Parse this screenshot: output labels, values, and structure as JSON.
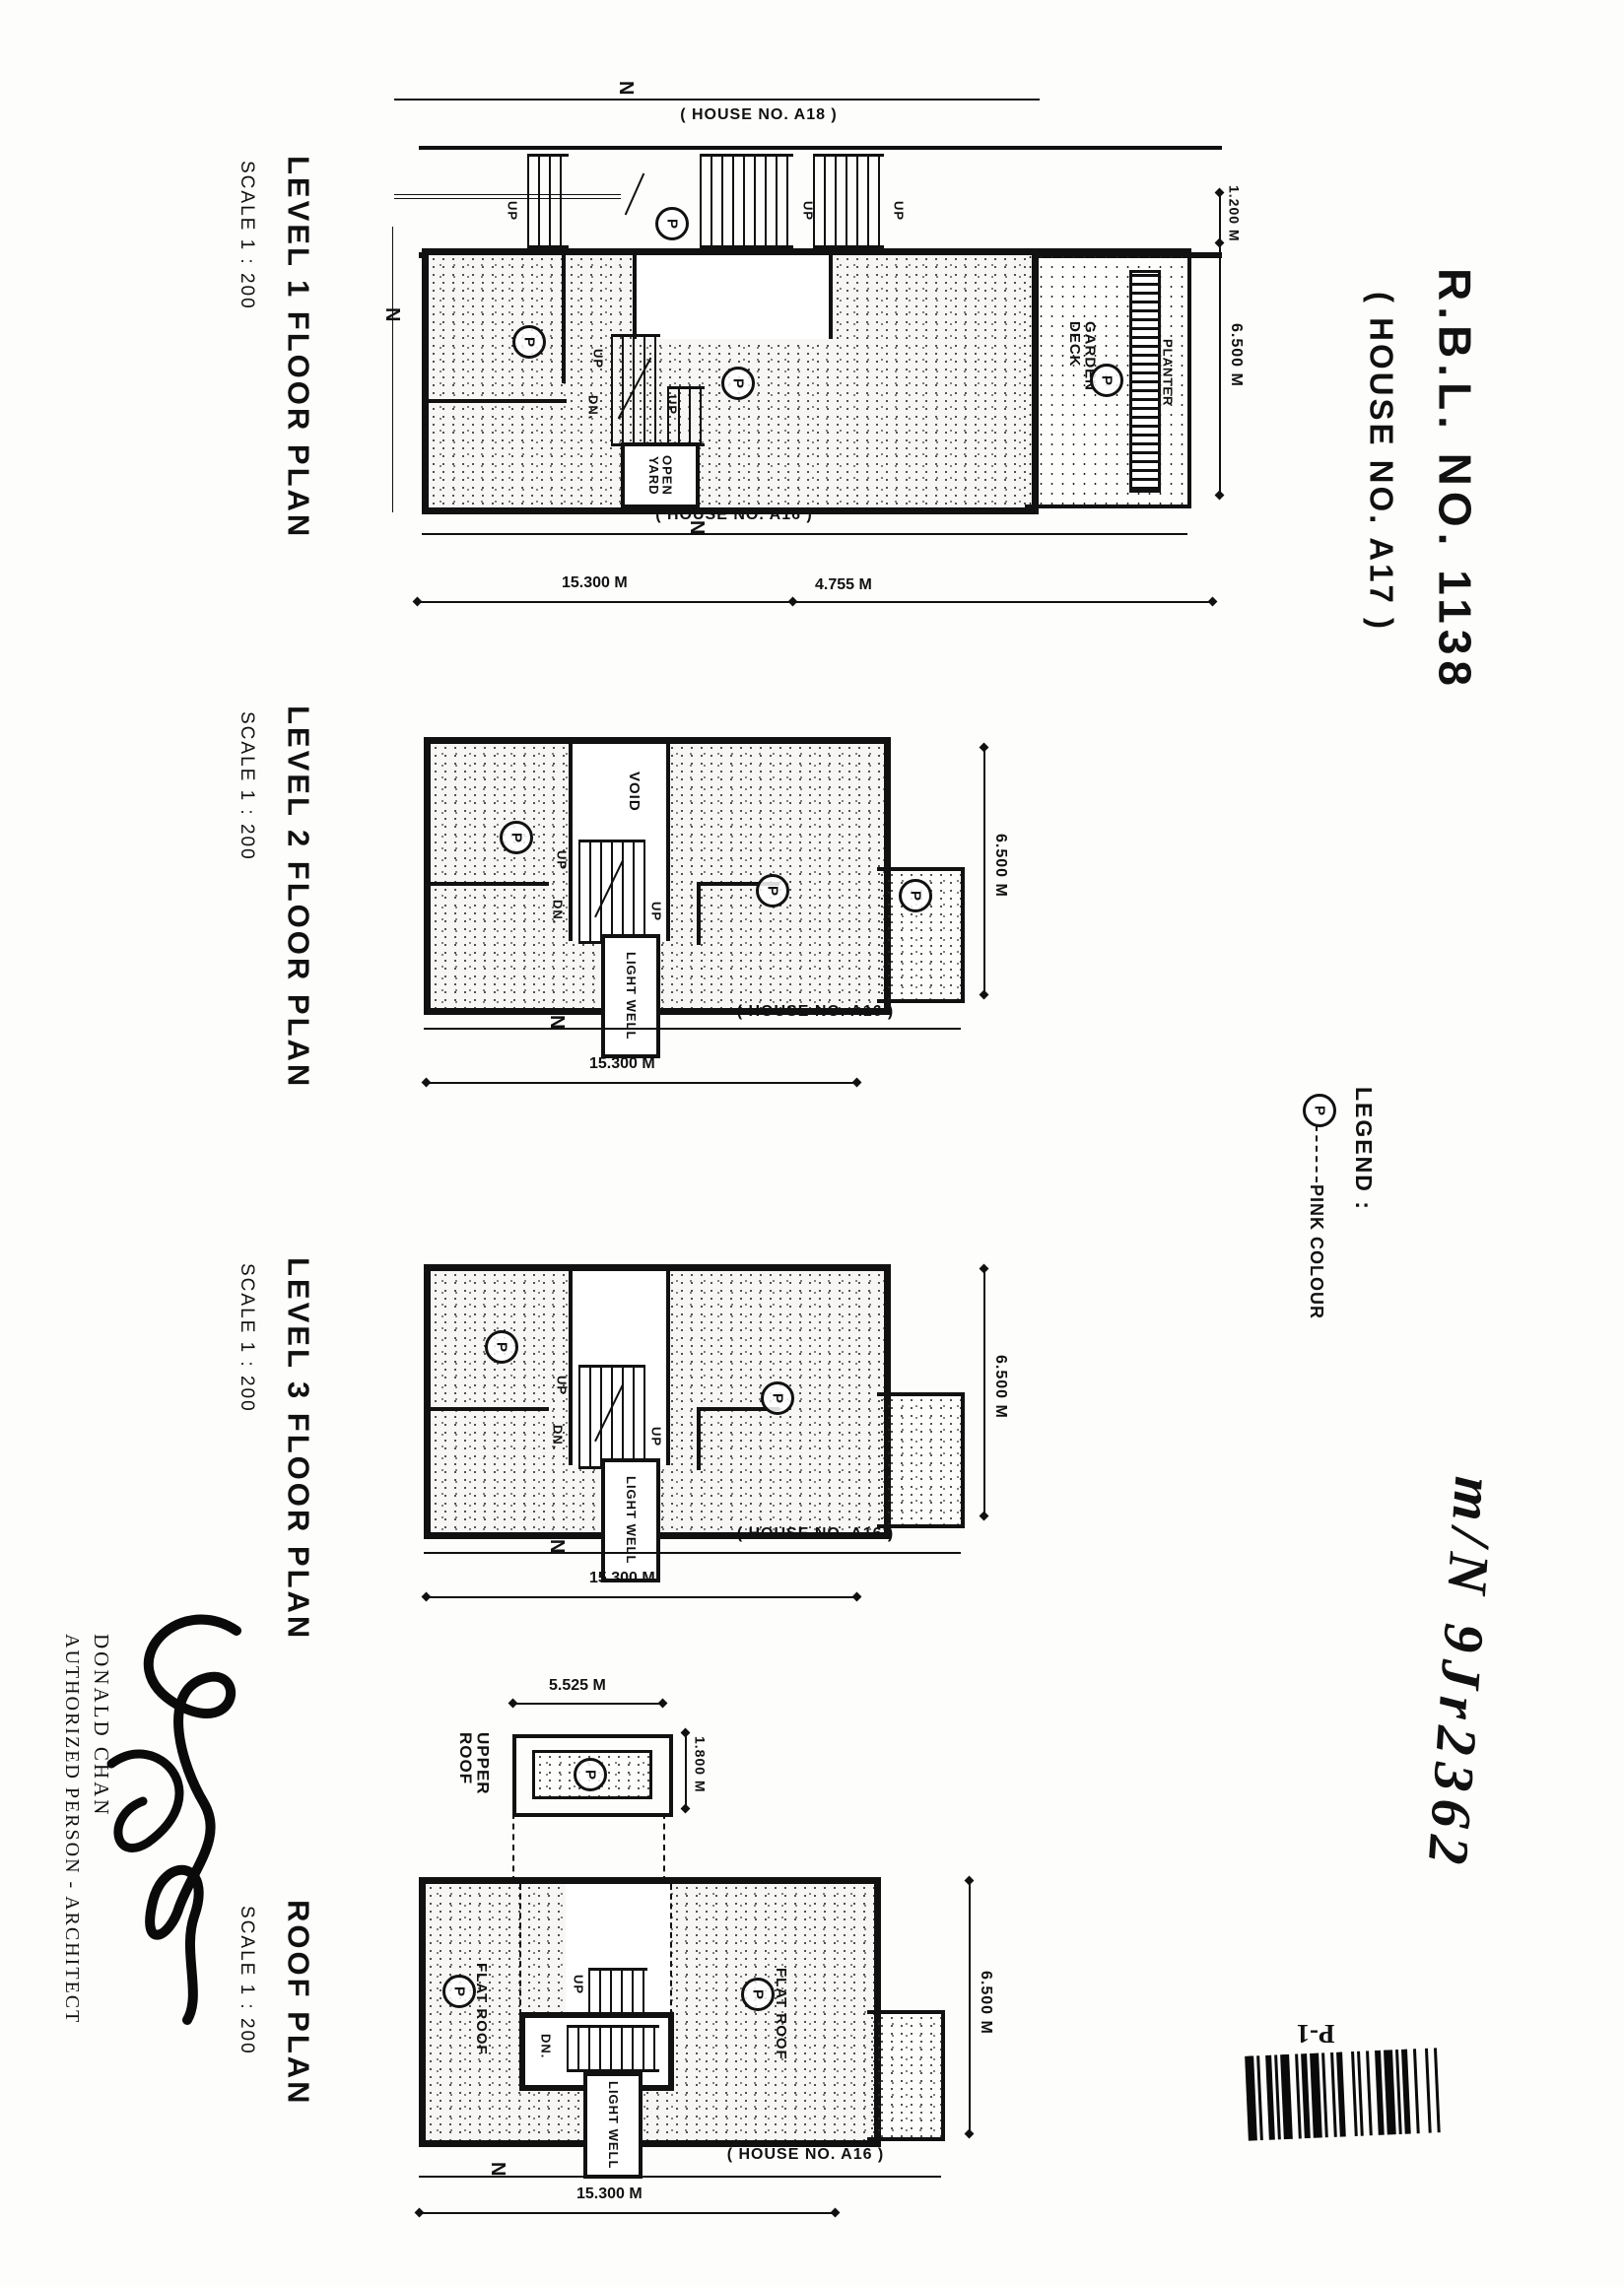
{
  "title": {
    "rbl": "R.B.L.  NO.  1138",
    "house": "( HOUSE  NO.  A17 )"
  },
  "common": {
    "up": "UP",
    "dn": "DN.",
    "p": "P",
    "n": "N",
    "scale": "SCALE 1 :  200",
    "light_well": "LIGHT WELL",
    "house_a16": "( HOUSE  NO. A16 )",
    "dim_15300": "15.300 M",
    "dim_6500": "6.500 M"
  },
  "level1": {
    "name": "LEVEL 1 FLOOR PLAN",
    "house_a18": "( HOUSE  NO. A18 )",
    "open_yard": "OPEN\nYARD",
    "garden_deck": "GARDEN DECK",
    "planter": "PLANTER",
    "dim_4755": "4.755 M",
    "dim_1200": "1.200 M"
  },
  "level2": {
    "name": "LEVEL 2 FLOOR PLAN",
    "void": "VOID"
  },
  "level3": {
    "name": "LEVEL 3 FLOOR PLAN"
  },
  "roof": {
    "name": "ROOF PLAN",
    "upper_roof": "UPPER\nROOF",
    "flat_roof": "FLAT ROOF",
    "dim_5525": "5.525 M",
    "dim_1800": "1.800 M"
  },
  "legend": {
    "heading": "LEGEND :",
    "color_label": "PINK COLOUR"
  },
  "annotations": {
    "handwritten": "m/N 9Jr2362",
    "architect_name": "DONALD CHAN",
    "architect_title": "AUTHORIZED PERSON - ARCHITECT",
    "page_code": "P-1"
  }
}
